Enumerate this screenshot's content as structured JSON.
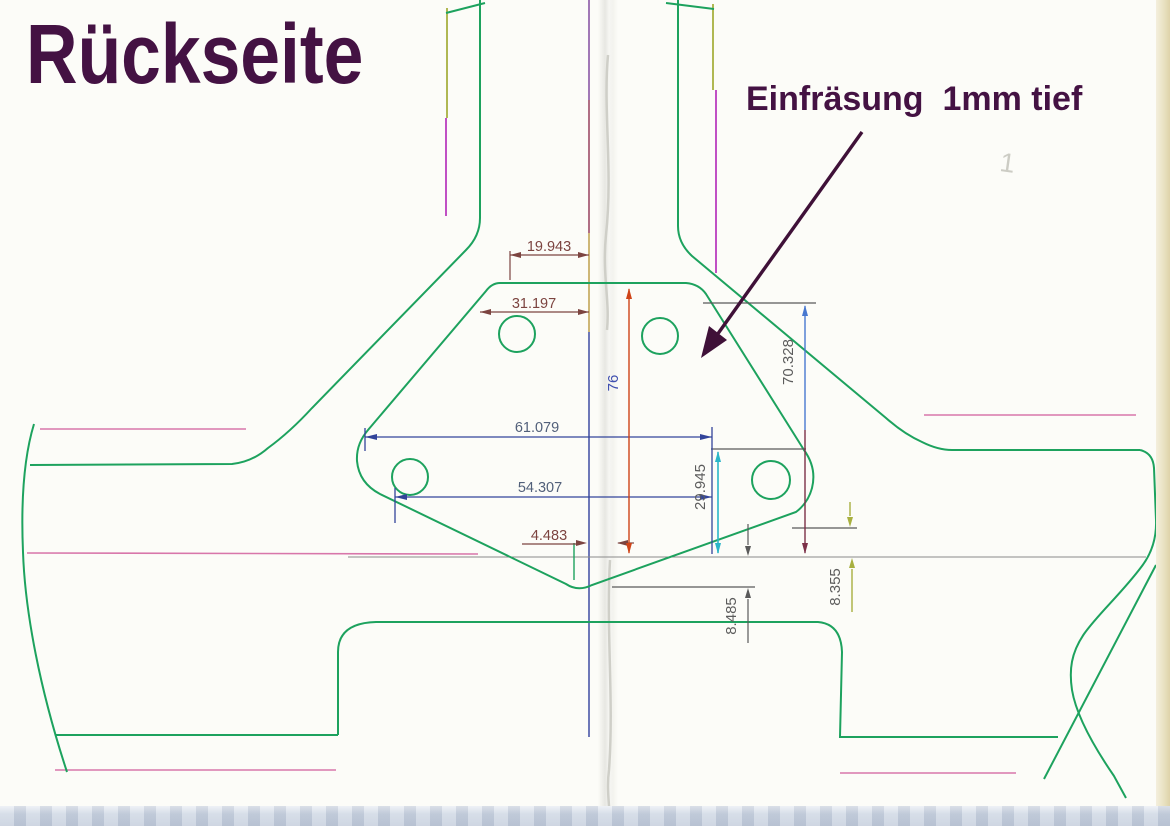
{
  "title": "Rückseite",
  "annotation": "Einfräsung  1mm tief",
  "pencil_mark": "1",
  "dimensions": {
    "top_offset": "19.943",
    "upper_hole_span": "31.197",
    "outer_width": "61.079",
    "hole_width": "54.307",
    "center_offset": "4.483",
    "total_height": "76",
    "right_height": "70.328",
    "hole_height": "29.945",
    "bottom_step_left": "8.485",
    "bottom_step_right": "8.355"
  },
  "colors": {
    "green": "#1da25e",
    "pink": "#d876aa",
    "magenta": "#b93cbe",
    "olive": "#a8b040",
    "baseline_gray": "#8a8a8a",
    "ext_gray": "#5a5a5a",
    "navy": "#32449a",
    "dim_dark": "#7c4440",
    "red_line": "#cf4418",
    "blue_seg": "#4878d0",
    "maroon_seg": "#7c3048",
    "cyan": "#2ab5c8",
    "purple_ink": "#3f1138",
    "blue_label": "#4050b0",
    "gray_label": "#5c5c5c",
    "navy_label": "#52607a",
    "center_purple": "#7a3f99",
    "center_maroon": "#8f3352",
    "center_gold": "#bb9a40",
    "center_navy": "#31409c",
    "seam_line": "#cfcfc8"
  }
}
